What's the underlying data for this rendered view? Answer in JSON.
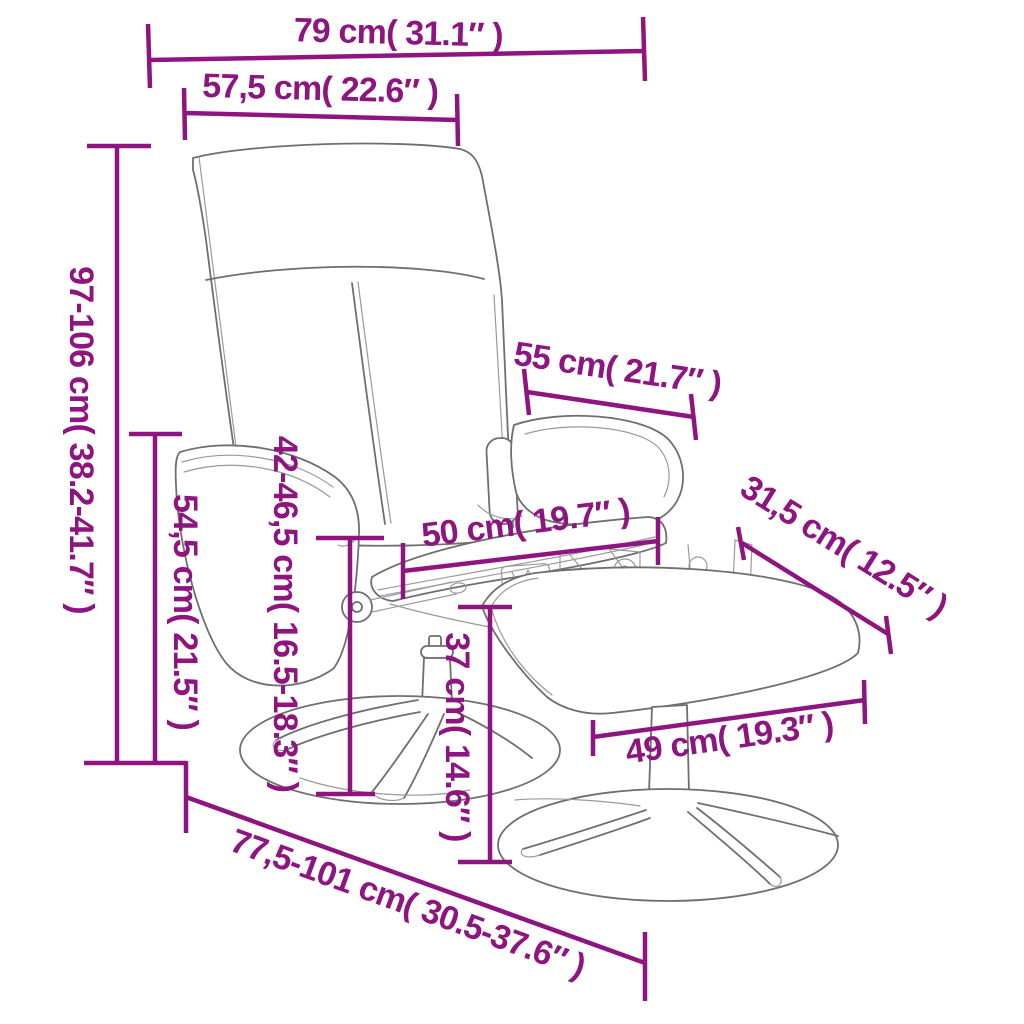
{
  "diagram": {
    "type": "product-dimension-diagram",
    "figure_description": "Line drawing of a swivel recliner chair with massage remote and a separate footstool, both on round pedestal bases",
    "background_color": "#ffffff",
    "accent_color": "#8e1480",
    "drawing_line_color": "#6f6f6f",
    "dimensions": [
      {
        "id": "overall-width",
        "label": "79 cm( 31.1″ )"
      },
      {
        "id": "backrest-width",
        "label": "57,5 cm( 22.6″ )"
      },
      {
        "id": "overall-height",
        "label": "97-106 cm( 38.2-41.7″ )"
      },
      {
        "id": "armrest-height",
        "label": "54,5 cm( 21.5″ )"
      },
      {
        "id": "seat-height",
        "label": "42-46,5 cm( 16.5-18.3″ )"
      },
      {
        "id": "backrest-depth",
        "label": "55 cm( 21.7″ )"
      },
      {
        "id": "seat-width",
        "label": "50 cm( 19.7″ )"
      },
      {
        "id": "footstool-depth",
        "label": "31,5 cm( 12.5″ )"
      },
      {
        "id": "footstool-height",
        "label": "37 cm( 14.6″ )"
      },
      {
        "id": "footstool-width",
        "label": "49 cm( 19.3″ )"
      },
      {
        "id": "overall-depth",
        "label": "77,5-101 cm( 30.5-37.6″ )"
      }
    ]
  }
}
